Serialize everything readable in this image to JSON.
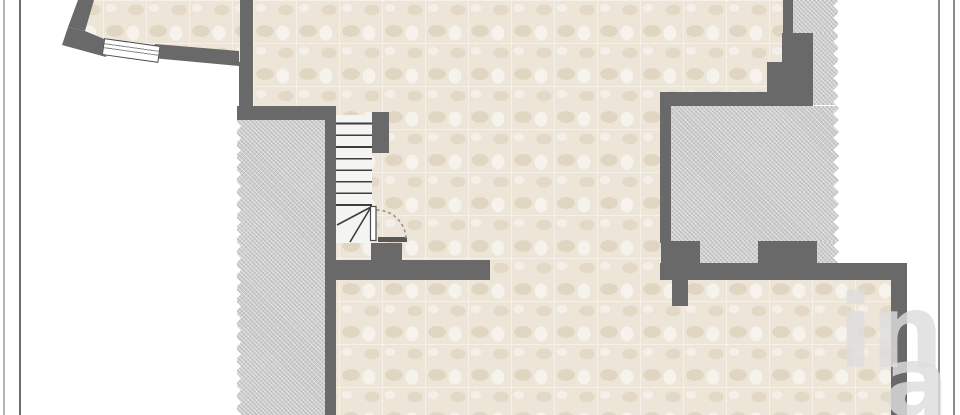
{
  "page": {
    "kind": "floor-plan-image",
    "visible_rooms": [
      "top-left-room",
      "main-room",
      "bottom-room"
    ],
    "features": [
      "staircase-with-winders",
      "door-with-swing-arc",
      "window",
      "hatched-uncovered-area-left",
      "hatched-uncovered-area-right",
      "page-frame-lines"
    ]
  },
  "watermark": {
    "primary": "in",
    "secondary": "a"
  },
  "colors": {
    "page": "#ffffff",
    "wall": "#696969",
    "floor": "#ece5d8",
    "floor_grout": "#f6f1e8",
    "floor_mottle": "#d8c9af",
    "hatch": "#cbcbcb",
    "stair_tread": "#f4f4f3",
    "stair_line": "#3e3e3e",
    "frame_line": "#8c8c8c",
    "frame_line_light": "#b5b5b5",
    "door_arc": "#9a9183",
    "watermark_color": "#dedede"
  }
}
